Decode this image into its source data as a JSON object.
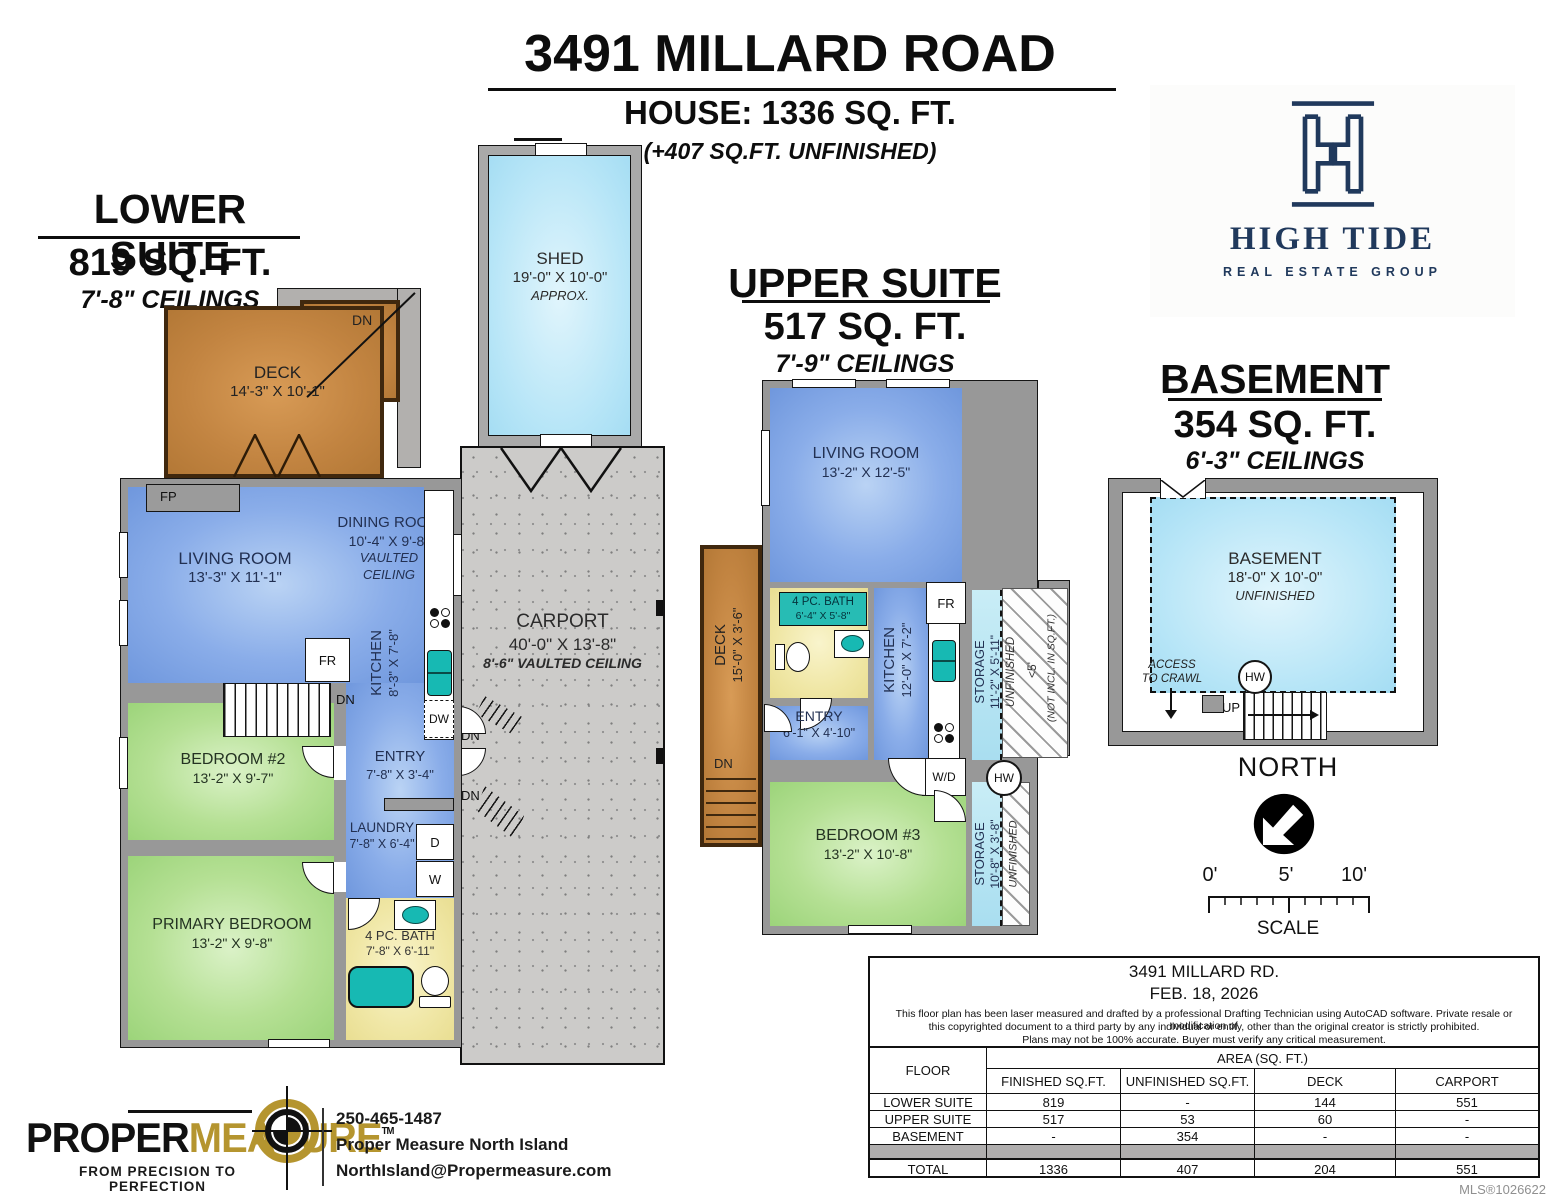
{
  "header": {
    "title": "3491 MILLARD ROAD",
    "house": "HOUSE: 1336 SQ. FT.",
    "note": "(+407 SQ.FT. UNFINISHED)"
  },
  "labels": {
    "fp": "FP",
    "fr": "FR",
    "dn": "DN",
    "dw": "DW",
    "d": "D",
    "w": "W",
    "wd": "W/D",
    "hw": "HW",
    "up": "UP"
  },
  "lower": {
    "title": "LOWER SUITE",
    "area": "819 SQ. FT.",
    "ceilings": "7'-8\" CEILINGS",
    "deck": {
      "name": "DECK",
      "dims": "14'-3\" X 10'-1\""
    },
    "living": {
      "name": "LIVING ROOM",
      "dims": "13'-3\" X 11'-1\""
    },
    "dining": {
      "name": "DINING ROOM",
      "dims": "10'-4\" X 9'-8\"",
      "note1": "VAULTED",
      "note2": "CEILING"
    },
    "kitchen": {
      "name": "KITCHEN",
      "dims": "8'-3\" X 7'-8\""
    },
    "bedroom2": {
      "name": "BEDROOM #2",
      "dims": "13'-2\" X 9'-7\""
    },
    "primary": {
      "name": "PRIMARY BEDROOM",
      "dims": "13'-2\" X 9'-8\""
    },
    "entry": {
      "name": "ENTRY",
      "dims": "7'-8\" X 3'-4\""
    },
    "laundry": {
      "name": "LAUNDRY",
      "dims": "7'-8\" X 6'-4\""
    },
    "bath": {
      "name": "4 PC. BATH",
      "dims": "7'-8\" X 6'-11\""
    }
  },
  "shed": {
    "name": "SHED",
    "dims": "19'-0\" X 10'-0\"",
    "note": "APPROX."
  },
  "carport": {
    "name": "CARPORT",
    "dims": "40'-0\" X 13'-8\"",
    "note": "8'-6\" VAULTED CEILING"
  },
  "upper": {
    "title": "UPPER SUITE",
    "area": "517 SQ. FT.",
    "ceilings": "7'-9\" CEILINGS",
    "living": {
      "name": "LIVING ROOM",
      "dims": "13'-2\" X 12'-5\""
    },
    "deck": {
      "name": "DECK",
      "dims": "15'-0\" X 3'-6\""
    },
    "bath": {
      "name": "4 PC. BATH",
      "dims": "6'-4\" X 5'-8\""
    },
    "entry": {
      "name": "ENTRY",
      "dims": "6'-1\" X 4'-10\""
    },
    "kitchen": {
      "name": "KITCHEN",
      "dims": "12'-0\" X 7'-2\""
    },
    "storage1": {
      "name": "STORAGE",
      "dims": "11'-2\" X 5'-11\"",
      "note": "UNFINISHED"
    },
    "hatchnote1": "<5'",
    "hatchnote2": "(NOT INCL. IN SQ.FT.)",
    "bedroom3": {
      "name": "BEDROOM #3",
      "dims": "13'-2\" X 10'-8\""
    },
    "storage2": {
      "name": "STORAGE",
      "dims": "10'-8\" X 3'-8\"",
      "note": "UNFINISHED"
    }
  },
  "basement": {
    "title": "BASEMENT",
    "area": "354 SQ. FT.",
    "ceilings": "6'-3\" CEILINGS",
    "room": {
      "name": "BASEMENT",
      "dims": "18'-0\" X 10'-0\"",
      "note": "UNFINISHED"
    },
    "access1": "ACCESS",
    "access2": "TO CRAWL"
  },
  "compass": {
    "label": "NORTH"
  },
  "scalebar": {
    "t0": "0'",
    "t5": "5'",
    "t10": "10'",
    "label": "SCALE"
  },
  "hightide": {
    "name": "HIGH TIDE",
    "sub": "REAL ESTATE GROUP",
    "navy": "#20395c"
  },
  "table": {
    "address": "3491 MILLARD RD.",
    "date": "FEB. 18, 2026",
    "disclaimer1": "This floor plan has been laser measured and drafted by a professional Drafting Technician using AutoCAD software. Private resale or modification of",
    "disclaimer2": "this copyrighted document to a third party by any individual or entity, other than the original creator is strictly prohibited.",
    "disclaimer3": "Plans may not be 100% accurate.  Buyer must verify any critical measurement.",
    "floor_header": "FLOOR",
    "area_header": "AREA (SQ. FT.)",
    "col1": "FINISHED SQ.FT.",
    "col2": "UNFINISHED SQ.FT.",
    "col3": "DECK",
    "col4": "CARPORT",
    "rows": [
      {
        "floor": "LOWER SUITE",
        "finished": "819",
        "unfinished": "-",
        "deck": "144",
        "carport": "551"
      },
      {
        "floor": "UPPER SUITE",
        "finished": "517",
        "unfinished": "53",
        "deck": "60",
        "carport": "-"
      },
      {
        "floor": "BASEMENT",
        "finished": "-",
        "unfinished": "354",
        "deck": "-",
        "carport": "-"
      }
    ],
    "total": {
      "floor": "TOTAL",
      "finished": "1336",
      "unfinished": "407",
      "deck": "204",
      "carport": "551"
    }
  },
  "footer": {
    "brand1": "PROPER",
    "brand2": "MEASURE",
    "tm": "TM",
    "tagline": "FROM PRECISION TO PERFECTION",
    "phone": "250-465-1487",
    "company": "Proper Measure North Island",
    "email": "NorthIsland@Propermeasure.com",
    "gold": "#b5952f"
  },
  "mls": "MLS®1026622"
}
